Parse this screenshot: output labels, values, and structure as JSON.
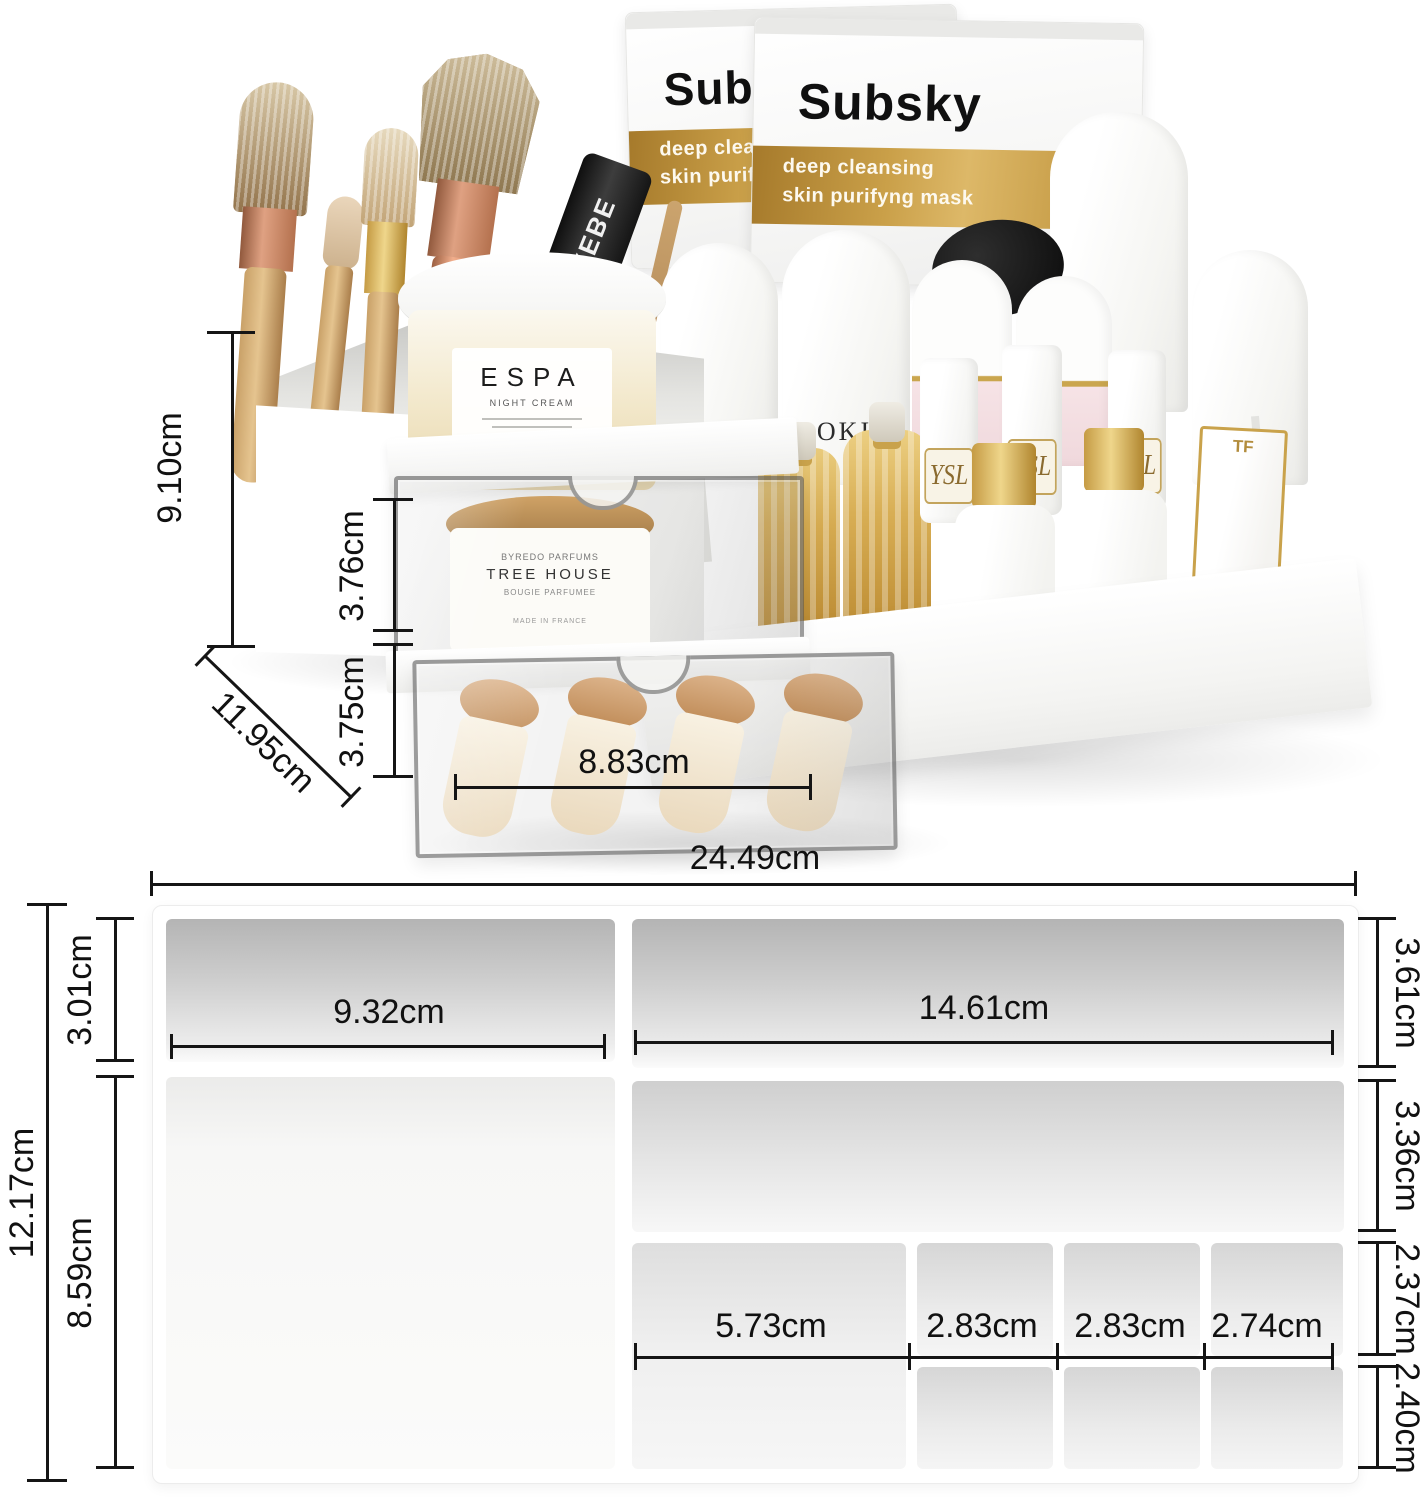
{
  "photo": {
    "mask_packets": {
      "brand": "Subsky",
      "tagline_line1": "deep cleansing",
      "tagline_line2": "skin purifyng mask"
    },
    "espa_jar": {
      "brand": "ESPA",
      "subtitle": "NIGHT CREAM"
    },
    "aokiji_bottle": {
      "brand": "AOKIJI"
    },
    "rebe_mascara": {
      "brand": "REBE"
    },
    "tree_house_jar": {
      "maker": "BYREDO PARFUMS",
      "name": "TREE HOUSE",
      "type": "BOUGIE PARFUMEE",
      "origin": "MADE IN FRANCE"
    },
    "babor_bottles": {
      "brand": "BABOR"
    },
    "tf_lipstick": {
      "brand": "TF"
    },
    "ysl_lipsticks": {
      "monogram": "YSL"
    },
    "dimensions": {
      "total_height": "9.10cm",
      "drawer1_height": "3.76cm",
      "drawer2_height": "3.75cm",
      "depth": "11.95cm",
      "drawer_inner_width": "8.83cm"
    }
  },
  "diagram": {
    "dimensions": {
      "total_width": "24.49cm",
      "total_depth": "12.17cm",
      "left_top_depth": "3.01cm",
      "left_section_width": "9.32cm",
      "left_bottom_depth": "8.59cm",
      "right_section_width": "14.61cm",
      "right_top_depth": "3.61cm",
      "right_middle_depth": "3.36cm",
      "right_row3_depth": "2.37cm",
      "right_row4_depth": "2.40cm",
      "slot1_width": "5.73cm",
      "slot2_width": "2.83cm",
      "slot3_width": "2.83cm",
      "slot4_width": "2.74cm"
    }
  },
  "colors": {
    "gold_band": "#c79a3d",
    "dimension_line": "#151515"
  }
}
